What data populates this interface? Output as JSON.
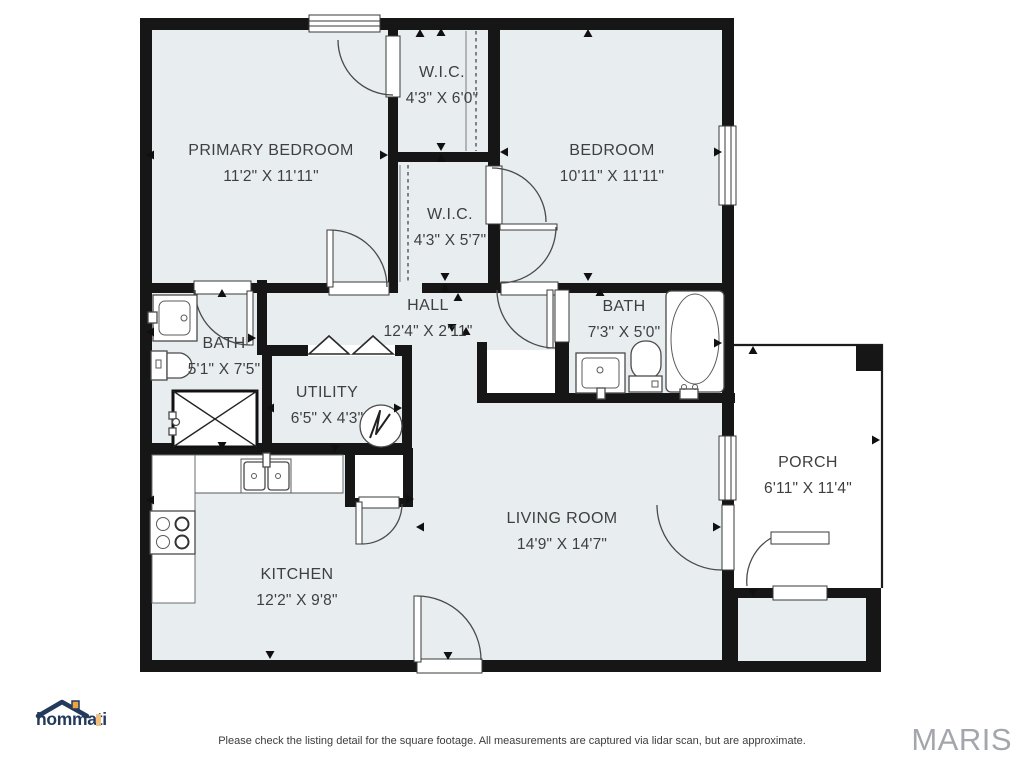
{
  "colors": {
    "wall": "#161616",
    "room_fill": "#e8edf0",
    "line": "#3a3a3a",
    "label": "#3f3f3f",
    "maris": "#a3a7ab",
    "logo_navy": "#233a5c",
    "logo_orange": "#eda440"
  },
  "rooms": [
    {
      "id": "primary-bedroom",
      "name": "PRIMARY BEDROOM",
      "dims": "11'2\" X 11'11\""
    },
    {
      "id": "wic-1",
      "name": "W.I.C.",
      "dims": "4'3\" X 6'0\""
    },
    {
      "id": "bedroom",
      "name": "BEDROOM",
      "dims": "10'11\" X 11'11\""
    },
    {
      "id": "wic-2",
      "name": "W.I.C.",
      "dims": "4'3\" X 5'7\""
    },
    {
      "id": "hall",
      "name": "HALL",
      "dims": "12'4\" X 2'11\""
    },
    {
      "id": "bath-left",
      "name": "BATH",
      "dims": "5'1\" X 7'5\""
    },
    {
      "id": "bath-right",
      "name": "BATH",
      "dims": "7'3\" X 5'0\""
    },
    {
      "id": "utility",
      "name": "UTILITY",
      "dims": "6'5\" X 4'3\""
    },
    {
      "id": "kitchen",
      "name": "KITCHEN",
      "dims": "12'2\" X 9'8\""
    },
    {
      "id": "living-room",
      "name": "LIVING ROOM",
      "dims": "14'9\" X 14'7\""
    },
    {
      "id": "porch",
      "name": "PORCH",
      "dims": "6'11\" X 11'4\""
    }
  ],
  "footer": {
    "logo_text": "hommati",
    "disclaimer": "Please check the listing detail for the square footage. All measurements are captured via lidar scan, but are approximate.",
    "brand": "MARIS"
  }
}
